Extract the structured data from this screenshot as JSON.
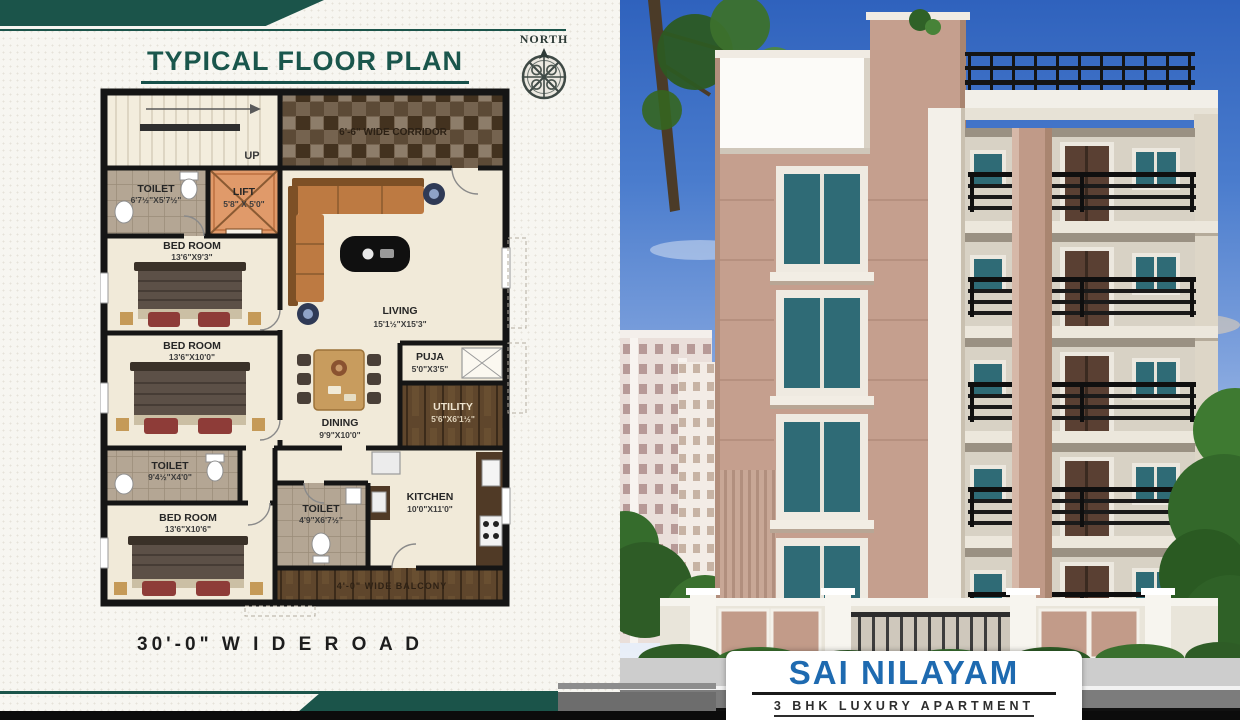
{
  "panel_left": {
    "title": "TYPICAL FLOOR PLAN",
    "north_label": "NORTH",
    "road_label": "30'-0\" W I D E   R O A D",
    "plan": {
      "stairs": {
        "label": "UP"
      },
      "corridor": {
        "label": "6'-6\" WIDE CORRIDOR"
      },
      "toilet_top": {
        "name": "TOILET",
        "dims": "6'7½\"X5'7½\""
      },
      "lift": {
        "name": "LIFT",
        "dims": "5'8\" X 5'0\""
      },
      "bedroom_1": {
        "name": "BED ROOM",
        "dims": "13'6\"X9'3\""
      },
      "living": {
        "name": "LIVING",
        "dims": "15'1½\"X15'3\""
      },
      "bedroom_2": {
        "name": "BED ROOM",
        "dims": "13'6\"X10'0\""
      },
      "puja": {
        "name": "PUJA",
        "dims": "5'0\"X3'5\""
      },
      "dining": {
        "name": "DINING",
        "dims": "9'9\"X10'0\""
      },
      "utility": {
        "name": "UTILITY",
        "dims": "5'6\"X6'1½\""
      },
      "toilet_mid": {
        "name": "TOILET",
        "dims": "9'4½\"X4'0\""
      },
      "toilet_low": {
        "name": "TOILET",
        "dims": "4'9\"X6'7½\""
      },
      "bedroom_3": {
        "name": "BED ROOM",
        "dims": "13'6\"X10'6\""
      },
      "kitchen": {
        "name": "KITCHEN",
        "dims": "10'0\"X11'0\""
      },
      "balcony": {
        "label": "4'-0\" WIDE BALCONY"
      }
    }
  },
  "panel_right": {
    "brand": {
      "name": "SAI NILAYAM",
      "tagline": "3 BHK LUXURY APARTMENT"
    }
  },
  "colors": {
    "accent_teal": "#1b544a",
    "title_teal": "#1a564c",
    "brand_blue": "#1e6ab0",
    "building_peach": "#c59f8e",
    "lift_orange": "#e09a6a",
    "plan_wall": "#151515",
    "window_glass_teal": "#2f6b76"
  }
}
